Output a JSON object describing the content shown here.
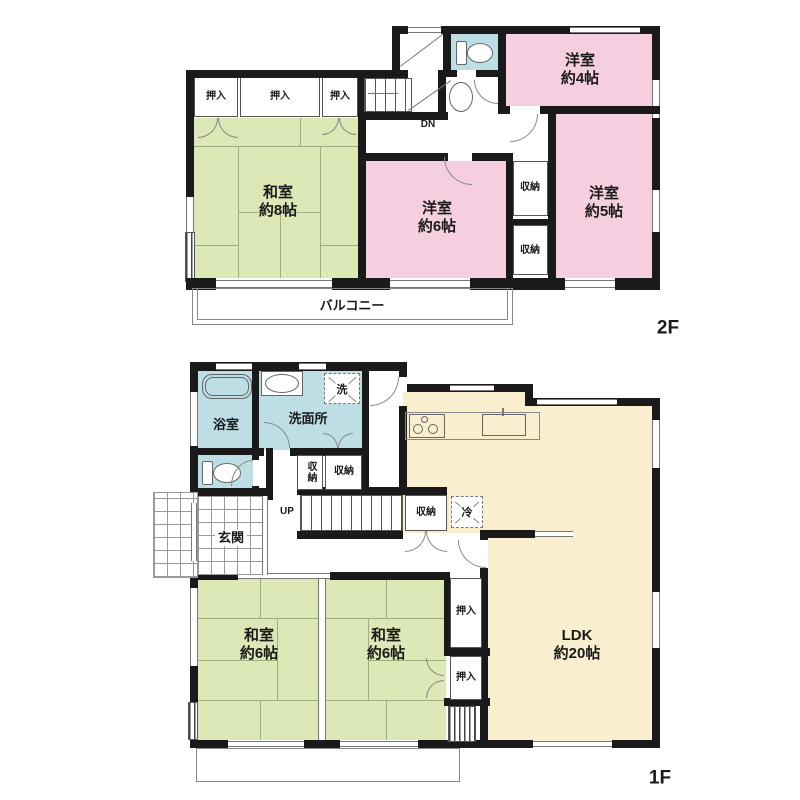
{
  "title": "住宅間取り図",
  "colors": {
    "wall": "#1a1a1a",
    "tatami": "#dce8b5",
    "western": "#f5cfe0",
    "wet": "#bedee6",
    "ldk": "#f9eecd"
  },
  "floor2": {
    "floor_label": "2F",
    "balcony": "バルコニー",
    "stairs_down": "DN",
    "closet": "押入",
    "storage": "収納",
    "washitsu8": {
      "name": "和室",
      "area": "約8帖"
    },
    "yoshitsu4": {
      "name": "洋室",
      "area": "約4帖"
    },
    "yoshitsu5": {
      "name": "洋室",
      "area": "約5帖"
    },
    "yoshitsu6": {
      "name": "洋室",
      "area": "約6帖"
    }
  },
  "floor1": {
    "floor_label": "1F",
    "stairs_up": "UP",
    "entrance": "玄関",
    "bathroom": "浴室",
    "washroom": "洗面所",
    "laundry": "洗",
    "refrigerator": "冷",
    "closet": "押入",
    "storage": "収納",
    "washitsu_left": {
      "name": "和室",
      "area": "約6帖"
    },
    "washitsu_right": {
      "name": "和室",
      "area": "約6帖"
    },
    "ldk": {
      "name": "LDK",
      "area": "約20帖"
    }
  }
}
